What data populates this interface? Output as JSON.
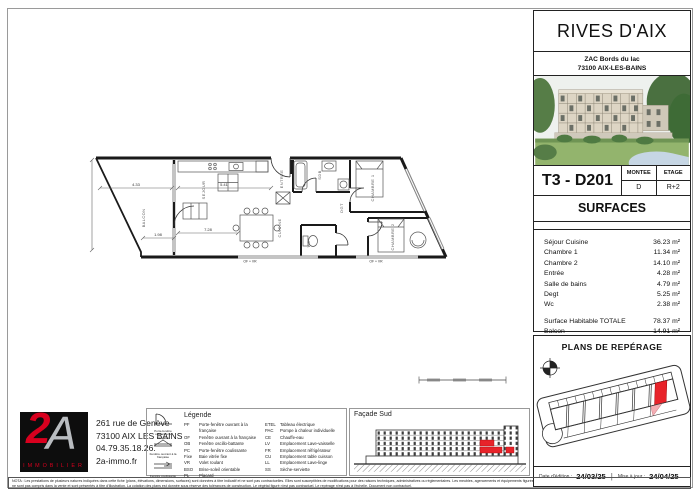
{
  "colors": {
    "red": "#e8232a",
    "logo_red": "#d8001e",
    "pink": "#f4aeb4",
    "wall": "#1a1a1a"
  },
  "header": {
    "title": "RIVES D'AIX",
    "address_line1": "ZAC Bords du lac",
    "address_line2": "73100 AIX-LES-BAINS"
  },
  "unit": {
    "code": "T3 - D201",
    "montee_label": "MONTEE",
    "montee_value": "D",
    "etage_label": "ETAGE",
    "etage_value": "R+2"
  },
  "surfaces": {
    "title": "SURFACES",
    "rows": [
      {
        "label": "Séjour Cuisine",
        "value": "36.23 m²"
      },
      {
        "label": "Chambre 1",
        "value": "11.34 m²"
      },
      {
        "label": "Chambre 2",
        "value": "14.10 m²"
      },
      {
        "label": "Entrée",
        "value": "4.28 m²"
      },
      {
        "label": "Salle de bains",
        "value": "4.79 m²"
      },
      {
        "label": "Degt",
        "value": "5.25 m²"
      },
      {
        "label": "Wc",
        "value": "2.38 m²"
      }
    ],
    "totals": [
      {
        "label": "Surface Habitable  TOTALE",
        "value": "78.37 m²"
      },
      {
        "label": "Balcon",
        "value": "14.91 m²"
      }
    ]
  },
  "reperage": {
    "title": "PLANS DE REPÉRAGE"
  },
  "dates": {
    "edition_label": "Date d'édition :",
    "edition_value": "24/03/25",
    "sep": "|",
    "maj_label": "Mise à jour :",
    "maj_value": "24/04/25"
  },
  "agency": {
    "logo_2": "2",
    "logo_a": "A",
    "logo_caption": "IMMOBILIER",
    "address1": "261 rue de Genève",
    "address2": "73100 AIX LES BAINS",
    "phone": "04.79.35.18.26.",
    "website": "2a-immo.fr"
  },
  "legend": {
    "title": "Légende",
    "symbols": [
      "Porte-fenêtre ouvrant à la française",
      "Fenêtre ouvrant à la française",
      "Fenêtre coulissante"
    ],
    "col1": [
      {
        "abbr": "PF",
        "label": "Porte-fenêtre ouvrant à la française"
      },
      {
        "abbr": "OF",
        "label": "Fenêtre ouvrant à la française"
      },
      {
        "abbr": "OB",
        "label": "Fenêtre oscillo-battante"
      },
      {
        "abbr": "PC",
        "label": "Porte-fenêtre coulissante"
      },
      {
        "abbr": "Fixe",
        "label": "Baie vitrée fixe"
      },
      {
        "abbr": "VR",
        "label": "Volet roulant"
      },
      {
        "abbr": "BSO",
        "label": "Brise-soleil orientable"
      },
      {
        "abbr": "PL",
        "label": "Placard"
      }
    ],
    "col2": [
      {
        "abbr": "ETEL",
        "label": "Tableau électrique"
      },
      {
        "abbr": "PAC",
        "label": "Pompe à chaleur individuelle"
      },
      {
        "abbr": "CE",
        "label": "Chauffe-eau"
      },
      {
        "abbr": "LV",
        "label": "Emplacement Lave-vaisselle"
      },
      {
        "abbr": "FR",
        "label": "Emplacement réfrigérateur"
      },
      {
        "abbr": "CU",
        "label": "Emplacement table cuisson"
      },
      {
        "abbr": "LL",
        "label": "Emplacement Lave-linge"
      },
      {
        "abbr": "SS",
        "label": "Sèche-serviette"
      }
    ]
  },
  "facade": {
    "title": "Façade Sud"
  },
  "plan": {
    "rooms": {
      "balcon": "BALCON",
      "sejour": "SEJOUR",
      "cuisine": "CUISINE",
      "entree": "ENTREE",
      "sdb": "SDB",
      "dgt": "DGT",
      "wc": "WC",
      "chambre1": "CHAMBRE 1",
      "chambre2": "CHAMBRE 2"
    },
    "dims": {
      "d1": "4.33",
      "d2": "5.41",
      "d3": "1.98",
      "d4": "7.28"
    },
    "window_label": "OF + VR"
  },
  "disclaimer": {
    "line1": "NOTA : Les prestations de plusieurs natures indiquées dans cette fiche (plans, élévations, dimensions, surfaces) sont données à titre indicatif et ne sont pas contractuelles. Elles sont susceptibles de modifications pour des raisons techniques, administratives ou réglementaires. Les meubles, agencements et équipements figurés",
    "line2": "ne sont pas compris dans la vente et sont présentés à titre d'illustration. La cotation des plans est donnée sous réserve des tolérances de construction. Le végétal figuré n'est pas contractuel. Le repérage n'est pas à l'échelle. Document non contractuel."
  }
}
